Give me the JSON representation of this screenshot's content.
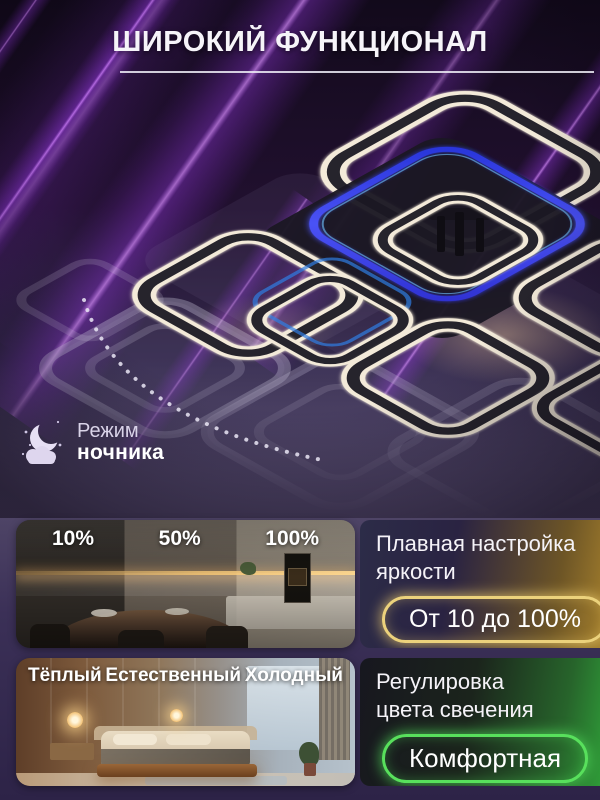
{
  "title": "ШИРОКИЙ ФУНКЦИОНАЛ",
  "night_mode": {
    "line1": "Режим",
    "line2": "ночника"
  },
  "features": [
    {
      "photo_labels": [
        "10%",
        "50%",
        "100%"
      ],
      "heading_line1": "Плавная настройка",
      "heading_line2": "яркости",
      "badge": "От 10 до 100%",
      "accent_color": "#ecd27c"
    },
    {
      "photo_labels": [
        "Тёплый",
        "Естественный",
        "Холодный"
      ],
      "heading_line1": "Регулировка",
      "heading_line2": "цвета свечения",
      "badge": "Комфортная",
      "accent_color": "#58e05c"
    }
  ],
  "colors": {
    "background_accent": "#8a2bd8",
    "led_blue": "#3743ea",
    "ring_light": "#f3ead9"
  }
}
